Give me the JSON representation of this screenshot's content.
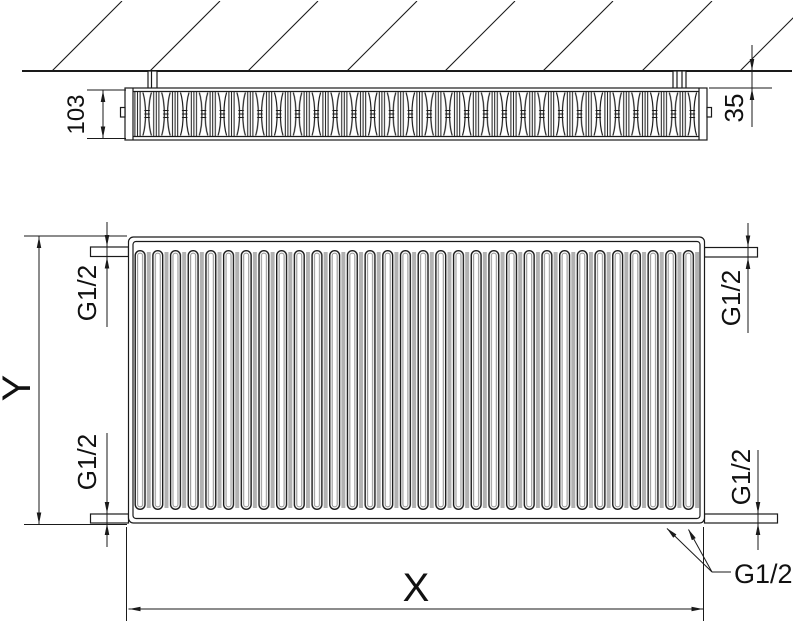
{
  "labels": {
    "depth": "103",
    "wall_gap": "35",
    "height": "Y",
    "width": "X",
    "conn_top_left": "G1/2",
    "conn_top_right": "G1/2",
    "conn_bottom_left": "G1/2",
    "conn_bottom_right": "G1/2",
    "conn_callout": "G1/2"
  },
  "colors": {
    "line": "#1a1a1a",
    "fin_gap": "#b2b2b2",
    "background": "#ffffff"
  }
}
